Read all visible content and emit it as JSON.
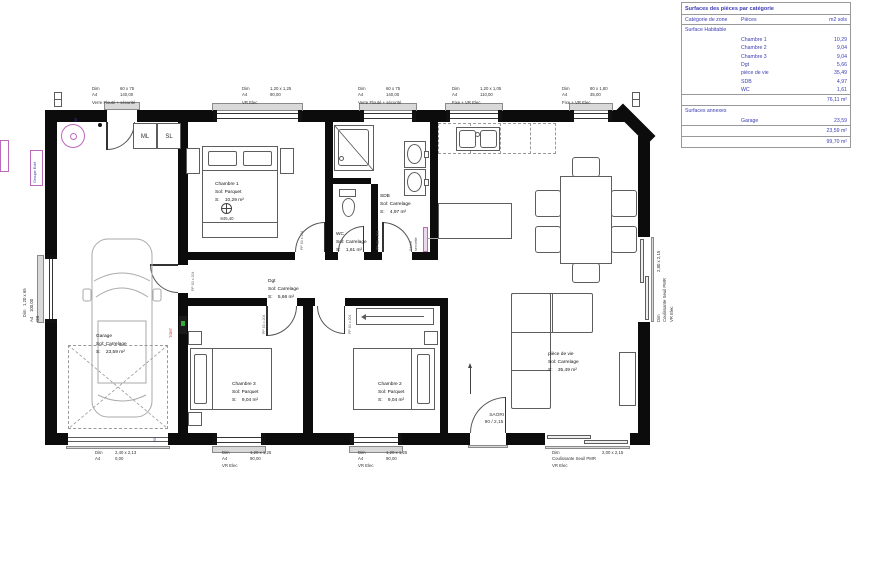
{
  "surface_table": {
    "title": "Surfaces des pièces par catégorie",
    "col_zone": "Catégorie de zone",
    "col_rooms": "Pièces",
    "col_area": "m2 sols",
    "habitable": {
      "section": "Surface Habitable",
      "rows": [
        {
          "name": "Chambre 1",
          "area": "10,29"
        },
        {
          "name": "Chambre 2",
          "area": "9,04"
        },
        {
          "name": "Chambre 3",
          "area": "9,04"
        },
        {
          "name": "Dgt",
          "area": "5,66"
        },
        {
          "name": "pièce de vie",
          "area": "35,49"
        },
        {
          "name": "SDB",
          "area": "4,97"
        },
        {
          "name": "WC",
          "area": "1,61"
        }
      ],
      "subtotal": "76,11 m²"
    },
    "annexes": {
      "section": "Surfaces annexes",
      "rows": [
        {
          "name": "Garage",
          "area": "23,59"
        }
      ],
      "subtotal": "23,59 m²"
    },
    "total": "99,70 m²"
  },
  "rooms": {
    "garage": {
      "name": "Garage",
      "floor": "Sol: Carrelage",
      "area": "S:    23,59 m²"
    },
    "chambre1": {
      "name": "Chambre 1",
      "floor": "Sol: Parquet",
      "area": "S:    10,29 m²"
    },
    "chambre2": {
      "name": "Chambre 2",
      "floor": "Sol: Parquet",
      "area": "S:    9,04 m²"
    },
    "chambre3": {
      "name": "Chambre 3",
      "floor": "Sol: Parquet",
      "area": "S:    9,04 m²"
    },
    "dgt": {
      "name": "Dgt",
      "floor": "Sol: Carrelage",
      "area": "S:    5,66 m²"
    },
    "piece_de_vie": {
      "name": "pièce de vie",
      "floor": "Sol: Carrelage",
      "area": "S:    35,49 m²"
    },
    "sdb": {
      "name": "SDB",
      "floor": "Sol: Carrelage",
      "area": "S:    4,97 m²"
    },
    "wc": {
      "name": "WC",
      "floor": "Sol: Carrelage",
      "area": "S:    1,61 m²"
    }
  },
  "openings": {
    "top1": {
      "dim": "Dim",
      "a4": "A4",
      "size": "60 x 75",
      "val": "140,00",
      "type": "Verre Flouté + sécurité"
    },
    "top2": {
      "dim": "Dim",
      "a4": "A4",
      "size": "1,20 x 1,25",
      "val": "90,00",
      "type": "VR Elec"
    },
    "top3": {
      "dim": "Dim",
      "a4": "A4",
      "size": "60 x 75",
      "val": "140,00",
      "type": "Verre Flouté + sécurité"
    },
    "top4": {
      "dim": "Dim",
      "a4": "A4",
      "size": "1,20 x 1,05",
      "val": "110,00",
      "type": "Fixe + VR Elec"
    },
    "top5": {
      "dim": "Dim",
      "a4": "A4",
      "size": "80 x 1,80",
      "val": "35,00",
      "type": "Fixe + VR Elec"
    },
    "bottom_garage": {
      "dim": "Dim",
      "a4": "A4",
      "size": "2,40 x 2,13",
      "val": "0,00"
    },
    "bottom_ch3": {
      "dim": "Dim",
      "a4": "A4",
      "size": "1,20 x 1,25",
      "val": "90,00",
      "type": "VR Elec"
    },
    "bottom_ch2": {
      "dim": "Dim",
      "a4": "A4",
      "size": "1,20 x 1,25",
      "val": "90,00",
      "type": "VR Elec"
    },
    "bottom_slider": {
      "dim": "Dim",
      "size": "2,00 x 2,15",
      "l2": "Coulissante Seuil PMR",
      "l3": "VR Elec"
    },
    "right_slider": {
      "dim": "Dim",
      "size": "2,80 x 2,15",
      "l2": "Coulissante Seuil PMR",
      "l3": "VR Elec"
    },
    "left_window": {
      "l1": "Dim   1,20 x 65",
      "l2": "A4    100,00",
      "l3": "OB"
    }
  },
  "misc": {
    "ml": "ML",
    "sl": "SL",
    "tgbt": "TGBT",
    "level_value": "845,40",
    "entry_name": "SAORI",
    "entry_size": "90 / 2,15",
    "door_tag": "PP 83 x 204",
    "groupe_ext": "Groupe Exté",
    "seche_l1": "Sèche",
    "seche_l2": "serviette",
    "dim_20": "20"
  }
}
